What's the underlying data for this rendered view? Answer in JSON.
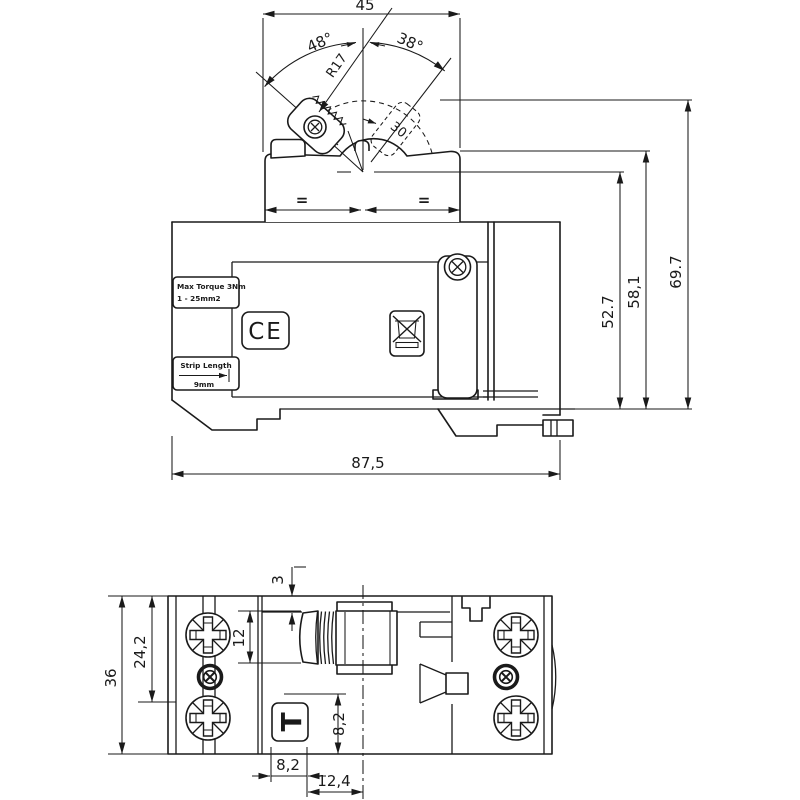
{
  "side": {
    "dim45": "45",
    "angle_left": "48°",
    "angle_right": "38°",
    "radius": "R17",
    "lever_dim": "30",
    "equal_left": "=",
    "equal_right": "=",
    "h_pivot": "52.7",
    "h_dome": "58,1",
    "h_total": "69.7",
    "w_total": "87,5",
    "torque1": "Max Torque 3Nm",
    "torque2": "1 - 25mm2",
    "strip1": "Strip Length",
    "strip2": "9mm",
    "ce": "CE"
  },
  "bottom": {
    "offset": "3",
    "handle": "12",
    "inner": "24,2",
    "height": "36",
    "test_h": "8,2",
    "test_w": "8,2",
    "test_center": "12,4",
    "test_label": "T"
  }
}
